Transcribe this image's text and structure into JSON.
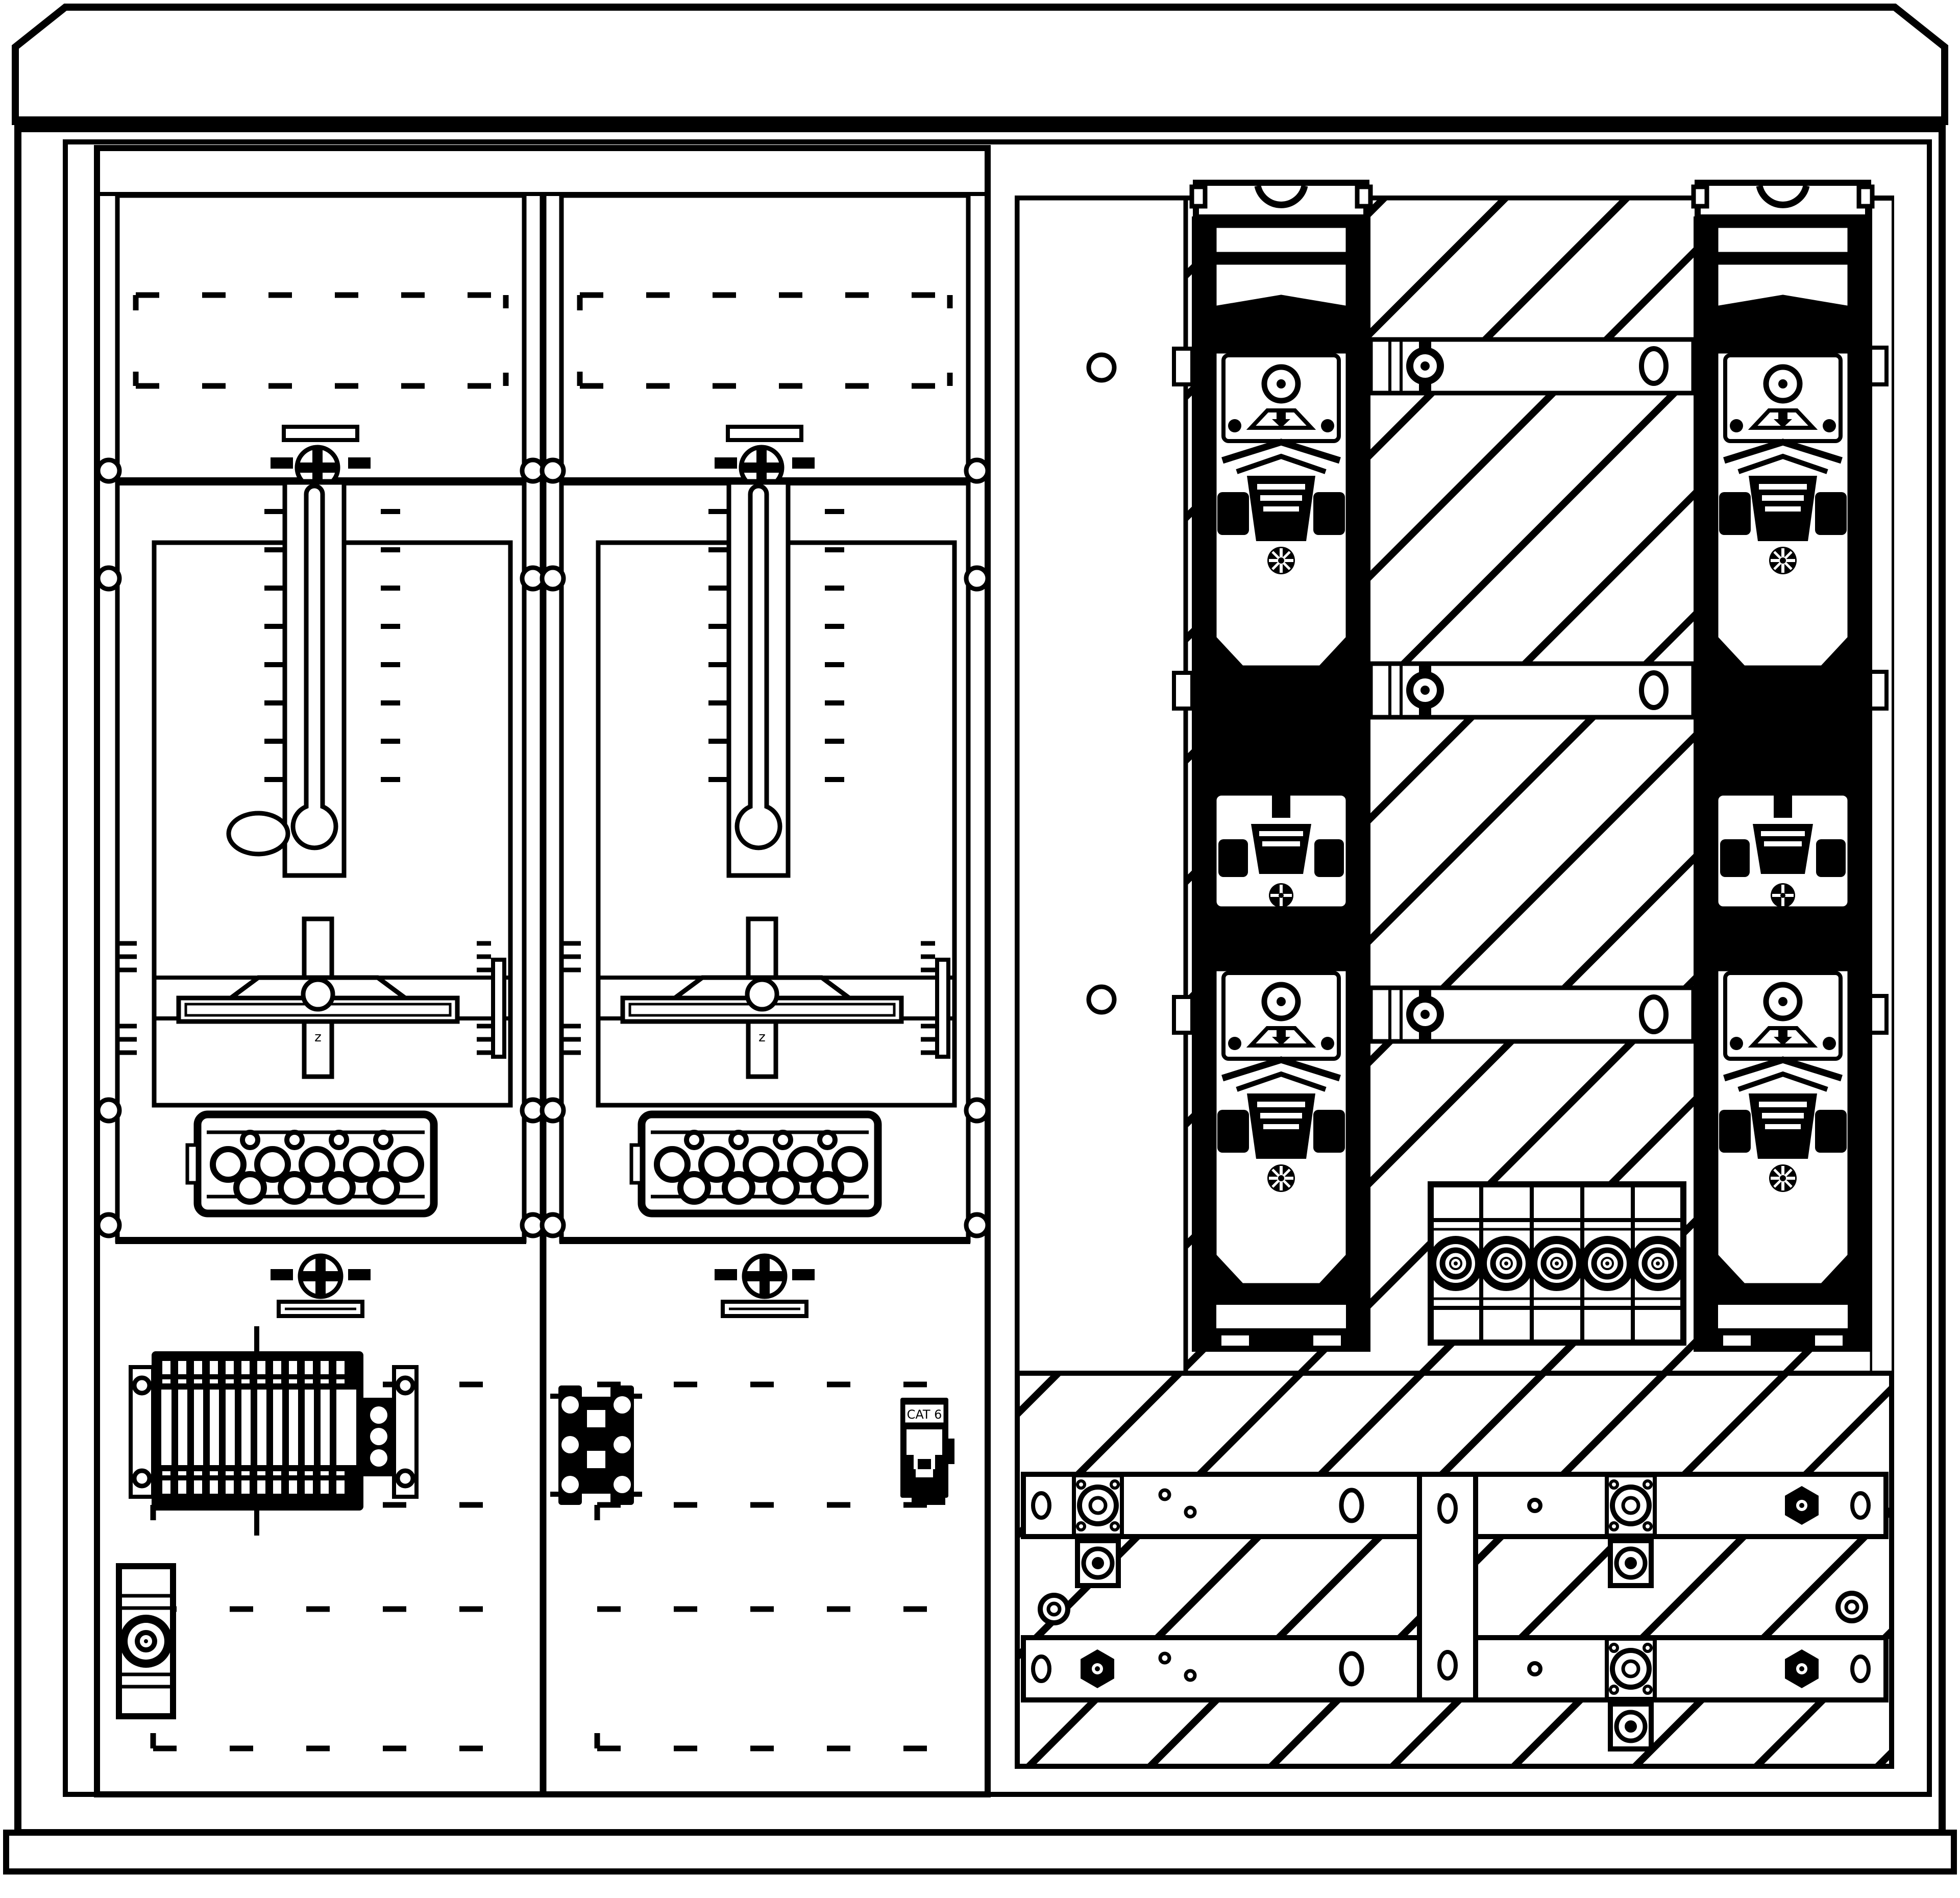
{
  "drawing": {
    "type": "electrical-cabinet-front-view",
    "labels": {
      "meter_cross_rail": "z",
      "network_jack": "CAT 6"
    },
    "colors": {
      "ink": "#000000",
      "paper": "#ffffff"
    }
  }
}
